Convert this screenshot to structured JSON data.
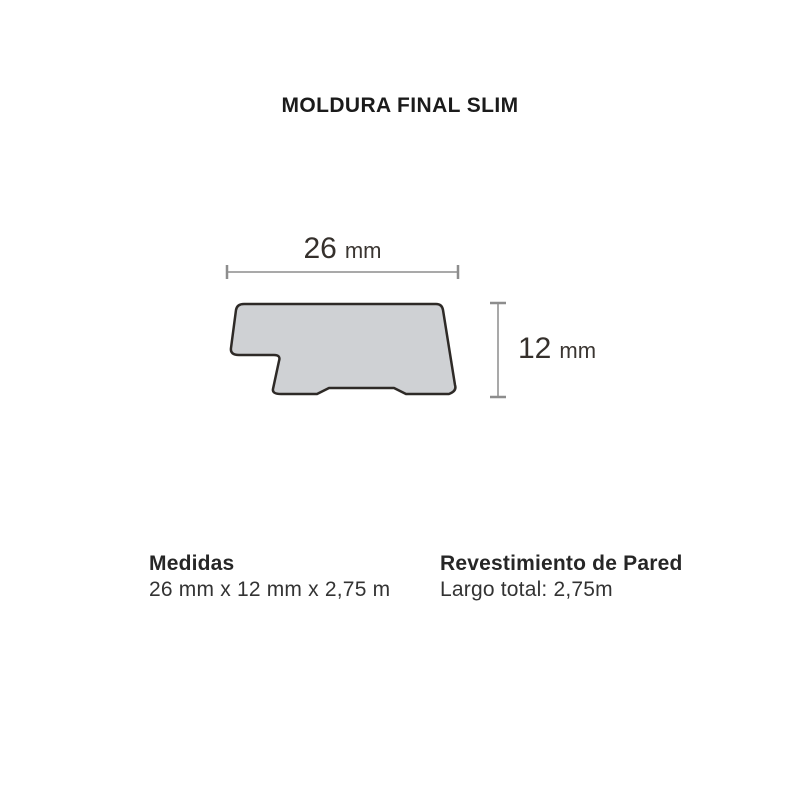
{
  "page": {
    "title": "MOLDURA FINAL SLIM"
  },
  "diagram": {
    "profile_name": "moldura-final-slim-cross-section",
    "width_dimension": {
      "value": "26",
      "unit": "mm"
    },
    "height_dimension": {
      "value": "12",
      "unit": "mm"
    },
    "colors": {
      "profile_fill": "#cfd1d4",
      "profile_stroke": "#2e2a27",
      "dimension_line": "#a9a9a9",
      "dimension_tick": "#8d8d8d",
      "dimension_text": "#35302c"
    }
  },
  "specs": {
    "measures": {
      "heading": "Medidas",
      "value": "26 mm x 12 mm x 2,75 m"
    },
    "coverage": {
      "heading": "Revestimiento de Pared",
      "value": "Largo total: 2,75m"
    }
  }
}
